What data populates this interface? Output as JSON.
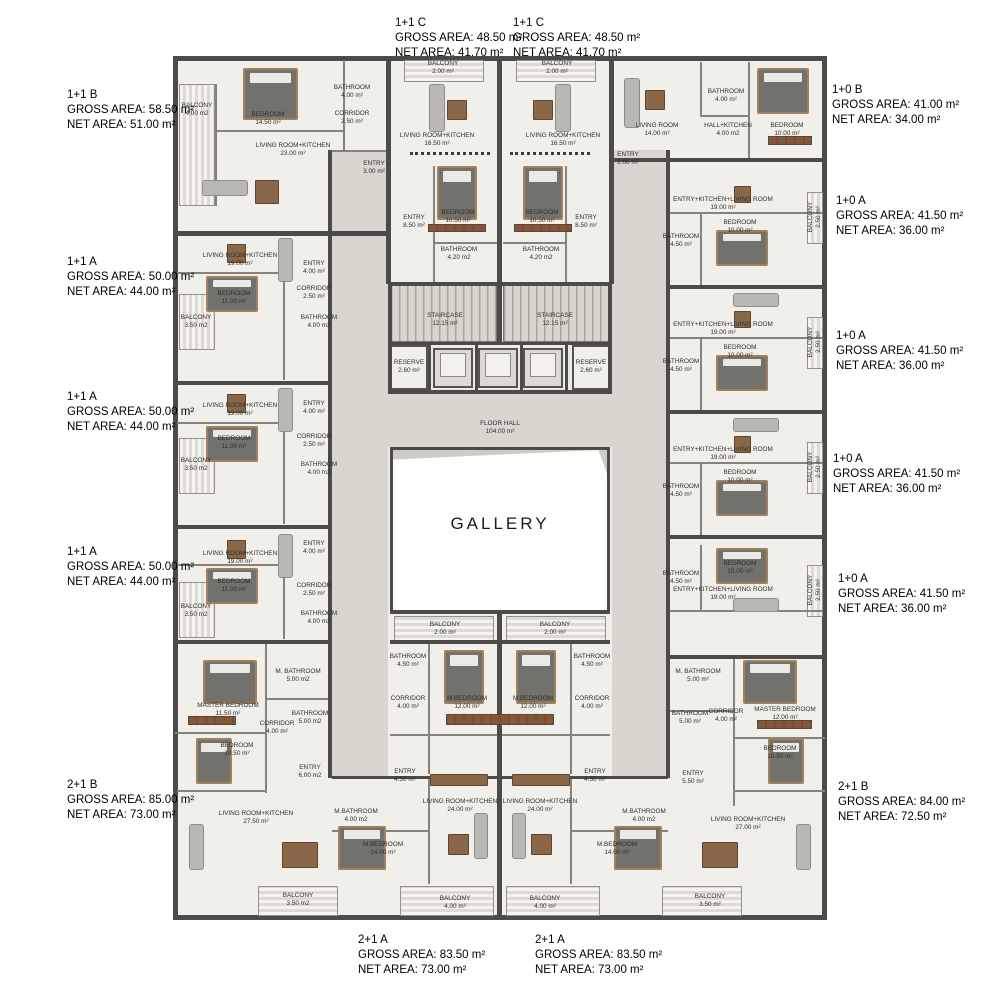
{
  "gallery_label": "GALLERY",
  "palette": {
    "wall": "#4c4b47",
    "room_floor": "#f1efe9",
    "corridor": "#d9d6cf",
    "balcony_stripe": "#dcdad3",
    "furniture_wood": "#8a6748",
    "wardrobe_accent": "#9c3d33",
    "text": "#000000"
  },
  "unit_labels": [
    {
      "label": "1+1 C",
      "gross": "GROSS AREA: 48.50 m²",
      "net": "NET AREA: 41.70 m²",
      "x": 395,
      "y": 16
    },
    {
      "label": "1+1 C",
      "gross": "GROSS AREA: 48.50 m²",
      "net": "NET AREA: 41.70 m²",
      "x": 513,
      "y": 16
    },
    {
      "label": "1+1 B",
      "gross": "GROSS AREA: 58.50 m²",
      "net": "NET AREA: 51.00 m²",
      "x": 67,
      "y": 88
    },
    {
      "label": "1+1 A",
      "gross": "GROSS AREA: 50.00 m²",
      "net": "NET AREA: 44.00 m²",
      "x": 67,
      "y": 255
    },
    {
      "label": "1+1 A",
      "gross": "GROSS AREA: 50.00 m²",
      "net": "NET AREA: 44.00 m²",
      "x": 67,
      "y": 390
    },
    {
      "label": "1+1 A",
      "gross": "GROSS AREA: 50.00 m²",
      "net": "NET AREA: 44.00 m²",
      "x": 67,
      "y": 545
    },
    {
      "label": "2+1 B",
      "gross": "GROSS AREA: 85.00 m²",
      "net": "NET AREA: 73.00 m²",
      "x": 67,
      "y": 778
    },
    {
      "label": "1+0 B",
      "gross": "GROSS AREA: 41.00 m²",
      "net": "NET AREA: 34.00 m²",
      "x": 832,
      "y": 83
    },
    {
      "label": "1+0 A",
      "gross": "GROSS AREA: 41.50 m²",
      "net": "NET AREA: 36.00 m²",
      "x": 836,
      "y": 194
    },
    {
      "label": "1+0 A",
      "gross": "GROSS AREA: 41.50 m²",
      "net": "NET AREA: 36.00 m²",
      "x": 836,
      "y": 329
    },
    {
      "label": "1+0 A",
      "gross": "GROSS AREA: 41.50 m²",
      "net": "NET AREA: 36.00 m²",
      "x": 833,
      "y": 452
    },
    {
      "label": "1+0 A",
      "gross": "GROSS AREA: 41.50 m²",
      "net": "NET AREA: 36.00 m²",
      "x": 838,
      "y": 572
    },
    {
      "label": "2+1 B",
      "gross": "GROSS AREA: 84.00 m²",
      "net": "NET AREA: 72.50 m²",
      "x": 838,
      "y": 780
    },
    {
      "label": "2+1 A",
      "gross": "GROSS AREA: 83.50 m²",
      "net": "NET AREA: 73.00 m²",
      "x": 358,
      "y": 933
    },
    {
      "label": "2+1 A",
      "gross": "GROSS AREA: 83.50 m²",
      "net": "NET AREA: 73.00 m²",
      "x": 535,
      "y": 933
    }
  ],
  "room_labels": [
    {
      "name": "BALCONY",
      "area": "4.00 m2",
      "x": 197,
      "y": 110
    },
    {
      "name": "BEDROOM",
      "area": "14.50 m²",
      "x": 268,
      "y": 119
    },
    {
      "name": "BATHROOM",
      "area": "4.00 m²",
      "x": 352,
      "y": 92
    },
    {
      "name": "CORRIDOR",
      "area": "2.50 m²",
      "x": 352,
      "y": 118
    },
    {
      "name": "LIVING ROOM+KITCHEN",
      "area": "23.00 m²",
      "x": 293,
      "y": 150
    },
    {
      "name": "ENTRY",
      "area": "3.00 m²",
      "x": 374,
      "y": 168
    },
    {
      "name": "LIVING ROOM+KITCHEN",
      "area": "19.00 m²",
      "x": 240,
      "y": 260
    },
    {
      "name": "ENTRY",
      "area": "4.00 m²",
      "x": 314,
      "y": 268
    },
    {
      "name": "CORRIDOR",
      "area": "2.50 m²",
      "x": 314,
      "y": 293
    },
    {
      "name": "BATHROOM",
      "area": "4.00 m2",
      "x": 319,
      "y": 322
    },
    {
      "name": "BEDROOM",
      "area": "11.00 m²",
      "x": 234,
      "y": 298
    },
    {
      "name": "BALCONY",
      "area": "3.50 m2",
      "x": 196,
      "y": 322
    },
    {
      "name": "LIVING ROOM+KITCHEN",
      "area": "19.00 m²",
      "x": 240,
      "y": 410
    },
    {
      "name": "ENTRY",
      "area": "4.00 m²",
      "x": 314,
      "y": 408
    },
    {
      "name": "CORRIDOR",
      "area": "2.50 m²",
      "x": 314,
      "y": 441
    },
    {
      "name": "BATHROOM",
      "area": "4.00 m2",
      "x": 319,
      "y": 469
    },
    {
      "name": "BEDROOM",
      "area": "11.00 m²",
      "x": 234,
      "y": 443
    },
    {
      "name": "BALCONY",
      "area": "3.50 m2",
      "x": 196,
      "y": 465
    },
    {
      "name": "LIVING ROOM+KITCHEN",
      "area": "19.00 m²",
      "x": 240,
      "y": 558
    },
    {
      "name": "ENTRY",
      "area": "4.00 m²",
      "x": 314,
      "y": 548
    },
    {
      "name": "CORRIDOR",
      "area": "2.50 m²",
      "x": 314,
      "y": 590
    },
    {
      "name": "BATHROOM",
      "area": "4.00 m2",
      "x": 319,
      "y": 618
    },
    {
      "name": "BEDROOM",
      "area": "11.00 m²",
      "x": 234,
      "y": 586
    },
    {
      "name": "BALCONY",
      "area": "3.50 m2",
      "x": 196,
      "y": 611
    },
    {
      "name": "MASTER BEDROOM",
      "area": "11.50 m²",
      "x": 228,
      "y": 710
    },
    {
      "name": "M. BATHROOM",
      "area": "5.00 m2",
      "x": 298,
      "y": 676
    },
    {
      "name": "BATHROOM",
      "area": "5.00 m2",
      "x": 310,
      "y": 718
    },
    {
      "name": "CORRIDOR",
      "area": "4.00 m²",
      "x": 277,
      "y": 728
    },
    {
      "name": "BEDROOM",
      "area": "10.50 m²",
      "x": 237,
      "y": 750
    },
    {
      "name": "ENTRY",
      "area": "6.00 m2",
      "x": 310,
      "y": 772
    },
    {
      "name": "LIVING ROOM+KITCHEN",
      "area": "27.50 m²",
      "x": 256,
      "y": 818
    },
    {
      "name": "BALCONY",
      "area": "3.50 m2",
      "x": 298,
      "y": 900
    },
    {
      "name": "BALCONY",
      "area": "2.00 m²",
      "x": 443,
      "y": 68
    },
    {
      "name": "BALCONY",
      "area": "2.00 m²",
      "x": 557,
      "y": 68
    },
    {
      "name": "LIVING ROOM+KITCHEN",
      "area": "16.50 m²",
      "x": 437,
      "y": 140
    },
    {
      "name": "LIVING ROOM+KITCHEN",
      "area": "16.50 m²",
      "x": 563,
      "y": 140
    },
    {
      "name": "BEDROOM",
      "area": "10.50 m²",
      "x": 458,
      "y": 217
    },
    {
      "name": "BEDROOM",
      "area": "10.50 m²",
      "x": 542,
      "y": 217
    },
    {
      "name": "ENTRY",
      "area": "8.50 m²",
      "x": 414,
      "y": 222
    },
    {
      "name": "ENTRY",
      "area": "8.50 m²",
      "x": 586,
      "y": 222
    },
    {
      "name": "BATHROOM",
      "area": "4.20 m2",
      "x": 459,
      "y": 254
    },
    {
      "name": "BATHROOM",
      "area": "4.20 m2",
      "x": 541,
      "y": 254
    },
    {
      "name": "STAIRCASE",
      "area": "12.15 m²",
      "x": 445,
      "y": 320
    },
    {
      "name": "STAIRCASE",
      "area": "12.15 m²",
      "x": 555,
      "y": 320
    },
    {
      "name": "RESERVE",
      "area": "2.60 m²",
      "x": 409,
      "y": 367
    },
    {
      "name": "RESERVE",
      "area": "2.60 m²",
      "x": 591,
      "y": 367
    },
    {
      "name": "FLOOR HALL",
      "area": "104.00 m²",
      "x": 500,
      "y": 428
    },
    {
      "name": "BALCONY",
      "area": "2.00 m²",
      "x": 445,
      "y": 629
    },
    {
      "name": "BALCONY",
      "area": "2.00 m²",
      "x": 555,
      "y": 629
    },
    {
      "name": "LIVING ROOM",
      "area": "14.00 m²",
      "x": 657,
      "y": 130
    },
    {
      "name": "BATHROOM",
      "area": "4.00 m²",
      "x": 726,
      "y": 96
    },
    {
      "name": "HALL+KITCHEN",
      "area": "4.00 m2",
      "x": 728,
      "y": 130
    },
    {
      "name": "BEDROOM",
      "area": "10.00 m²",
      "x": 787,
      "y": 130
    },
    {
      "name": "ENTRY",
      "area": "2.00 m²",
      "x": 628,
      "y": 159
    },
    {
      "name": "ENTRY+KITCHEN+LIVING ROOM",
      "area": "19.00 m²",
      "x": 723,
      "y": 204
    },
    {
      "name": "BEDROOM",
      "area": "10.00 m²",
      "x": 740,
      "y": 227
    },
    {
      "name": "BATHROOM",
      "area": "4.50 m²",
      "x": 681,
      "y": 241
    },
    {
      "name": "BALCONY",
      "area": "2.50 m²",
      "x": 815,
      "y": 217,
      "rot": 90
    },
    {
      "name": "ENTRY+KITCHEN+LIVING ROOM",
      "area": "19.00 m²",
      "x": 723,
      "y": 329
    },
    {
      "name": "BEDROOM",
      "area": "10.00 m²",
      "x": 740,
      "y": 352
    },
    {
      "name": "BATHROOM",
      "area": "4.50 m²",
      "x": 681,
      "y": 366
    },
    {
      "name": "BALCONY",
      "area": "2.50 m²",
      "x": 815,
      "y": 342,
      "rot": 90
    },
    {
      "name": "ENTRY+KITCHEN+LIVING ROOM",
      "area": "19.00 m²",
      "x": 723,
      "y": 454
    },
    {
      "name": "BEDROOM",
      "area": "10.00 m²",
      "x": 740,
      "y": 477
    },
    {
      "name": "BATHROOM",
      "area": "4.50 m²",
      "x": 681,
      "y": 491
    },
    {
      "name": "BALCONY",
      "area": "2.50 m²",
      "x": 815,
      "y": 467,
      "rot": 90
    },
    {
      "name": "ENTRY+KITCHEN+LIVING ROOM",
      "area": "19.00 m²",
      "x": 723,
      "y": 594
    },
    {
      "name": "BEDROOM",
      "area": "10.00 m²",
      "x": 740,
      "y": 568
    },
    {
      "name": "BATHROOM",
      "area": "4.50 m²",
      "x": 681,
      "y": 578
    },
    {
      "name": "BALCONY",
      "area": "2.50 m²",
      "x": 815,
      "y": 590,
      "rot": 90
    },
    {
      "name": "M. BATHROOM",
      "area": "5.00 m²",
      "x": 698,
      "y": 676
    },
    {
      "name": "BATHROOM",
      "area": "5.00 m²",
      "x": 690,
      "y": 718
    },
    {
      "name": "CORRIDOR",
      "area": "4.00 m²",
      "x": 726,
      "y": 716
    },
    {
      "name": "MASTER BEDROOM",
      "area": "12.00 m²",
      "x": 785,
      "y": 714
    },
    {
      "name": "BEDROOM",
      "area": "10.50 m²",
      "x": 780,
      "y": 753
    },
    {
      "name": "ENTRY",
      "area": "5.50 m²",
      "x": 693,
      "y": 778
    },
    {
      "name": "LIVING ROOM+KITCHEN",
      "area": "27.00 m²",
      "x": 748,
      "y": 824
    },
    {
      "name": "BALCONY",
      "area": "3.50 m²",
      "x": 710,
      "y": 901
    },
    {
      "name": "BATHROOM",
      "area": "4.50 m²",
      "x": 408,
      "y": 661
    },
    {
      "name": "BATHROOM",
      "area": "4.50 m²",
      "x": 592,
      "y": 661
    },
    {
      "name": "CORRIDOR",
      "area": "4.00 m²",
      "x": 408,
      "y": 703
    },
    {
      "name": "CORRIDOR",
      "area": "4.00 m²",
      "x": 592,
      "y": 703
    },
    {
      "name": "M.BEDROOM",
      "area": "12.00 m²",
      "x": 467,
      "y": 703
    },
    {
      "name": "M.BEDROOM",
      "area": "12.00 m²",
      "x": 533,
      "y": 703
    },
    {
      "name": "ENTRY",
      "area": "4.50 m²",
      "x": 405,
      "y": 776
    },
    {
      "name": "ENTRY",
      "area": "4.50 m²",
      "x": 595,
      "y": 776
    },
    {
      "name": "M.BATHROOM",
      "area": "4.00 m2",
      "x": 356,
      "y": 816
    },
    {
      "name": "M.BATHROOM",
      "area": "4.00 m2",
      "x": 644,
      "y": 816
    },
    {
      "name": "M.BEDROOM",
      "area": "14.00 m²",
      "x": 383,
      "y": 849
    },
    {
      "name": "M.BEDROOM",
      "area": "14.00 m²",
      "x": 617,
      "y": 849
    },
    {
      "name": "LIVING ROOM+KITCHEN",
      "area": "24.00 m²",
      "x": 460,
      "y": 806
    },
    {
      "name": "LIVING ROOM+KITCHEN",
      "area": "24.00 m²",
      "x": 540,
      "y": 806
    },
    {
      "name": "BALCONY",
      "area": "4.00 m²",
      "x": 455,
      "y": 903
    },
    {
      "name": "BALCONY",
      "area": "4.00 m²",
      "x": 545,
      "y": 903
    }
  ],
  "furniture": [
    {
      "t": "bed",
      "x": 243,
      "y": 68,
      "w": 55,
      "h": 52
    },
    {
      "t": "bed",
      "x": 206,
      "y": 276,
      "w": 52,
      "h": 36
    },
    {
      "t": "bed",
      "x": 206,
      "y": 426,
      "w": 52,
      "h": 36
    },
    {
      "t": "bed",
      "x": 206,
      "y": 568,
      "w": 52,
      "h": 36
    },
    {
      "t": "bed",
      "x": 437,
      "y": 166,
      "w": 40,
      "h": 54
    },
    {
      "t": "bed",
      "x": 523,
      "y": 166,
      "w": 40,
      "h": 54
    },
    {
      "t": "bed",
      "x": 757,
      "y": 68,
      "w": 52,
      "h": 46
    },
    {
      "t": "bed",
      "x": 716,
      "y": 230,
      "w": 52,
      "h": 36
    },
    {
      "t": "bed",
      "x": 716,
      "y": 355,
      "w": 52,
      "h": 36
    },
    {
      "t": "bed",
      "x": 716,
      "y": 480,
      "w": 52,
      "h": 36
    },
    {
      "t": "bed",
      "x": 716,
      "y": 548,
      "w": 52,
      "h": 36
    },
    {
      "t": "bed",
      "x": 444,
      "y": 650,
      "w": 40,
      "h": 54
    },
    {
      "t": "bed",
      "x": 516,
      "y": 650,
      "w": 40,
      "h": 54
    },
    {
      "t": "bed",
      "x": 338,
      "y": 826,
      "w": 48,
      "h": 44
    },
    {
      "t": "bed",
      "x": 614,
      "y": 826,
      "w": 48,
      "h": 44
    },
    {
      "t": "bed",
      "x": 203,
      "y": 660,
      "w": 54,
      "h": 44
    },
    {
      "t": "bed",
      "x": 743,
      "y": 660,
      "w": 54,
      "h": 44
    },
    {
      "t": "bed",
      "x": 196,
      "y": 738,
      "w": 36,
      "h": 46
    },
    {
      "t": "bed",
      "x": 768,
      "y": 738,
      "w": 36,
      "h": 46
    },
    {
      "t": "sofa",
      "x": 202,
      "y": 180,
      "w": 46,
      "h": 16
    },
    {
      "t": "sofa",
      "x": 278,
      "y": 238,
      "w": 15,
      "h": 44
    },
    {
      "t": "sofa",
      "x": 278,
      "y": 388,
      "w": 15,
      "h": 44
    },
    {
      "t": "sofa",
      "x": 278,
      "y": 534,
      "w": 15,
      "h": 44
    },
    {
      "t": "sofa",
      "x": 429,
      "y": 84,
      "w": 16,
      "h": 48
    },
    {
      "t": "sofa",
      "x": 555,
      "y": 84,
      "w": 16,
      "h": 48
    },
    {
      "t": "sofa",
      "x": 624,
      "y": 78,
      "w": 16,
      "h": 50
    },
    {
      "t": "sofa",
      "x": 733,
      "y": 293,
      "w": 46,
      "h": 14
    },
    {
      "t": "sofa",
      "x": 733,
      "y": 418,
      "w": 46,
      "h": 14
    },
    {
      "t": "sofa",
      "x": 733,
      "y": 598,
      "w": 46,
      "h": 14
    },
    {
      "t": "sofa",
      "x": 474,
      "y": 813,
      "w": 14,
      "h": 46
    },
    {
      "t": "sofa",
      "x": 512,
      "y": 813,
      "w": 14,
      "h": 46
    },
    {
      "t": "sofa",
      "x": 189,
      "y": 824,
      "w": 15,
      "h": 46
    },
    {
      "t": "sofa",
      "x": 796,
      "y": 824,
      "w": 15,
      "h": 46
    },
    {
      "t": "table",
      "x": 255,
      "y": 180,
      "w": 24,
      "h": 24
    },
    {
      "t": "table",
      "x": 227,
      "y": 244,
      "w": 19,
      "h": 19
    },
    {
      "t": "table",
      "x": 227,
      "y": 394,
      "w": 19,
      "h": 19
    },
    {
      "t": "table",
      "x": 227,
      "y": 540,
      "w": 19,
      "h": 19
    },
    {
      "t": "table",
      "x": 447,
      "y": 100,
      "w": 20,
      "h": 20
    },
    {
      "t": "table",
      "x": 533,
      "y": 100,
      "w": 20,
      "h": 20
    },
    {
      "t": "table",
      "x": 645,
      "y": 90,
      "w": 20,
      "h": 20
    },
    {
      "t": "table",
      "x": 734,
      "y": 186,
      "w": 17,
      "h": 17
    },
    {
      "t": "table",
      "x": 734,
      "y": 311,
      "w": 17,
      "h": 17
    },
    {
      "t": "table",
      "x": 734,
      "y": 436,
      "w": 17,
      "h": 17
    },
    {
      "t": "table",
      "x": 448,
      "y": 834,
      "w": 21,
      "h": 21
    },
    {
      "t": "table",
      "x": 531,
      "y": 834,
      "w": 21,
      "h": 21
    },
    {
      "t": "table",
      "x": 282,
      "y": 842,
      "w": 36,
      "h": 26
    },
    {
      "t": "table",
      "x": 702,
      "y": 842,
      "w": 36,
      "h": 26
    },
    {
      "t": "table",
      "x": 430,
      "y": 774,
      "w": 58,
      "h": 12
    },
    {
      "t": "table",
      "x": 512,
      "y": 774,
      "w": 58,
      "h": 12
    },
    {
      "t": "ward",
      "x": 188,
      "y": 716,
      "w": 48,
      "h": 9
    },
    {
      "t": "ward",
      "x": 757,
      "y": 720,
      "w": 55,
      "h": 9
    },
    {
      "t": "ward",
      "x": 446,
      "y": 714,
      "w": 108,
      "h": 11
    },
    {
      "t": "ward",
      "x": 428,
      "y": 224,
      "w": 58,
      "h": 8
    },
    {
      "t": "ward",
      "x": 514,
      "y": 224,
      "w": 58,
      "h": 8
    },
    {
      "t": "ward",
      "x": 768,
      "y": 136,
      "w": 44,
      "h": 9
    }
  ]
}
